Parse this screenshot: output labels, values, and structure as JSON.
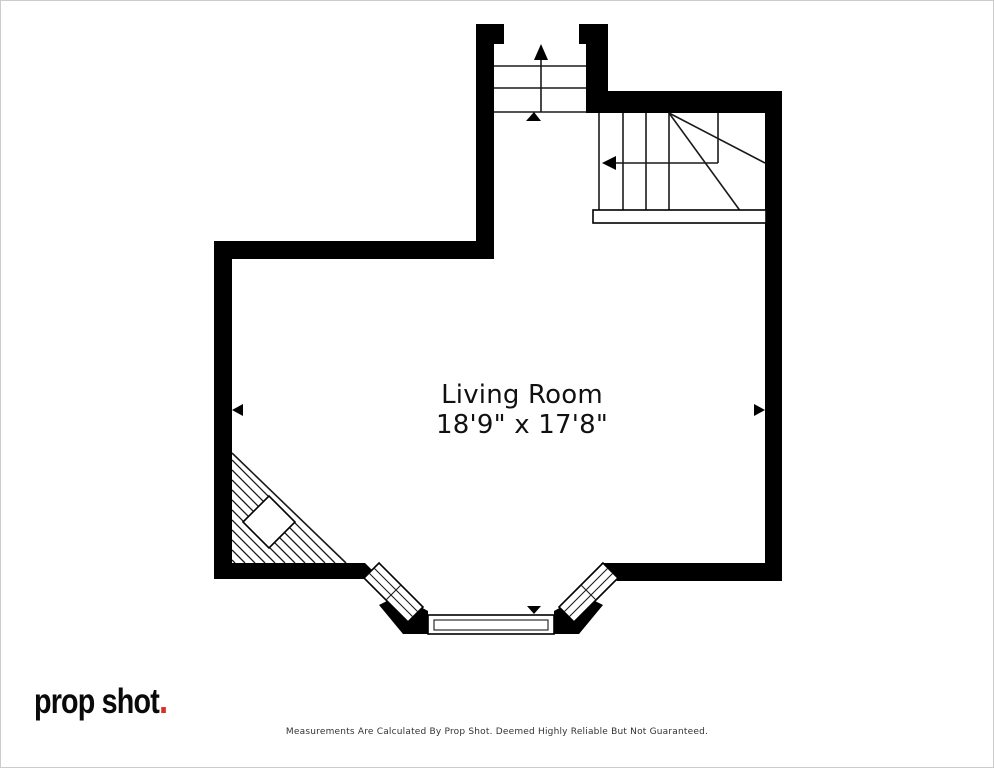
{
  "canvas": {
    "width": 994,
    "height": 768
  },
  "colors": {
    "wall": "#000000",
    "stair_line": "#1a1a1a",
    "logo_text": "#0a0a0a",
    "logo_dot": "#d93025",
    "room_label": "#111111",
    "disclaimer": "#333333",
    "canvas_border": "#cccccc"
  },
  "room": {
    "name": "Living Room",
    "dimensions": "18'9\" x 17'8\""
  },
  "branding": {
    "logo_text": "prop shot",
    "logo_dot": "."
  },
  "footer": {
    "disclaimer": "Measurements Are Calculated By Prop Shot. Deemed Highly Reliable But Not Guaranteed."
  }
}
